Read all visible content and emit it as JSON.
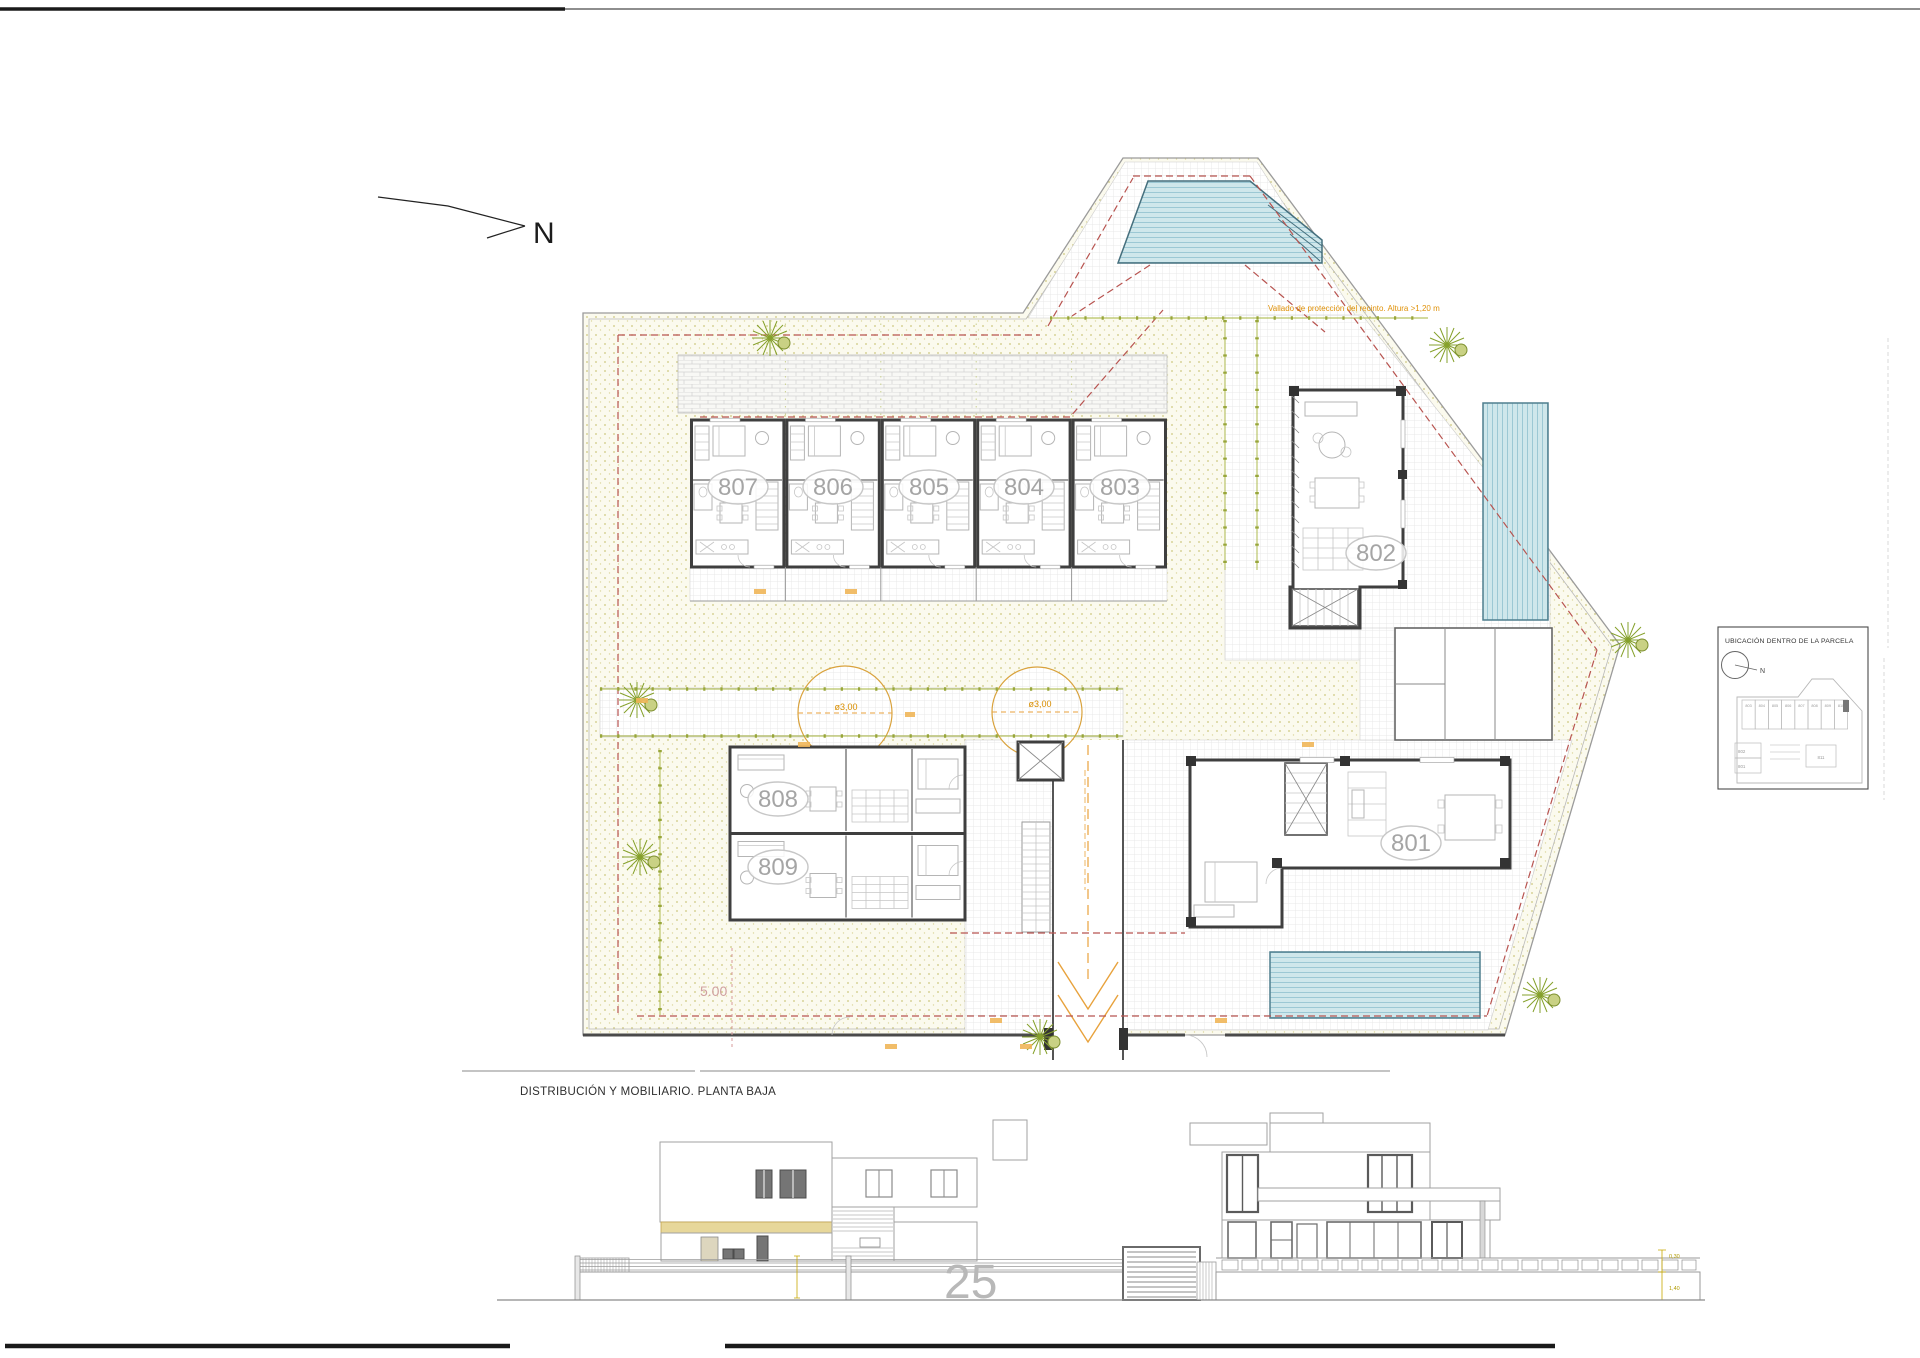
{
  "sheet": {
    "title": "DISTRIBUCIÓN Y MOBILIARIO. PLANTA BAJA",
    "sheet_number": "25"
  },
  "plan": {
    "north_label": "N",
    "fence_note": "Vallado de protección del recinto. Altura >1,20 m",
    "setback_dim": "5.00",
    "circle_dims": [
      "ø3,00",
      "ø3,00"
    ],
    "row_units": [
      "807",
      "806",
      "805",
      "804",
      "803"
    ],
    "lower_units": [
      "808",
      "809"
    ],
    "villa_units": [
      "802",
      "801"
    ]
  },
  "inset": {
    "title": "UBICACIÓN DENTRO DE LA PARCELA",
    "north_label": "N",
    "row_units": [
      "803",
      "804",
      "805",
      "806",
      "807",
      "808",
      "809",
      "810"
    ],
    "left_units": [
      "802",
      "801"
    ],
    "center_unit": "811"
  },
  "elevation": {
    "dims": [
      "0,30",
      "1,40"
    ]
  },
  "colors": {
    "setback_red": "#b85450",
    "fence_green": "#98a63a",
    "marking_orange": "#e8a23c",
    "note_orange": "#e0920a",
    "pool_blue": "#cfe7eb",
    "pool_stripe": "#9cc8d4",
    "awning_yellow": "#e7d79a",
    "ground_stipple": "#cdc87f",
    "label_grey": "#a5a5a5"
  }
}
